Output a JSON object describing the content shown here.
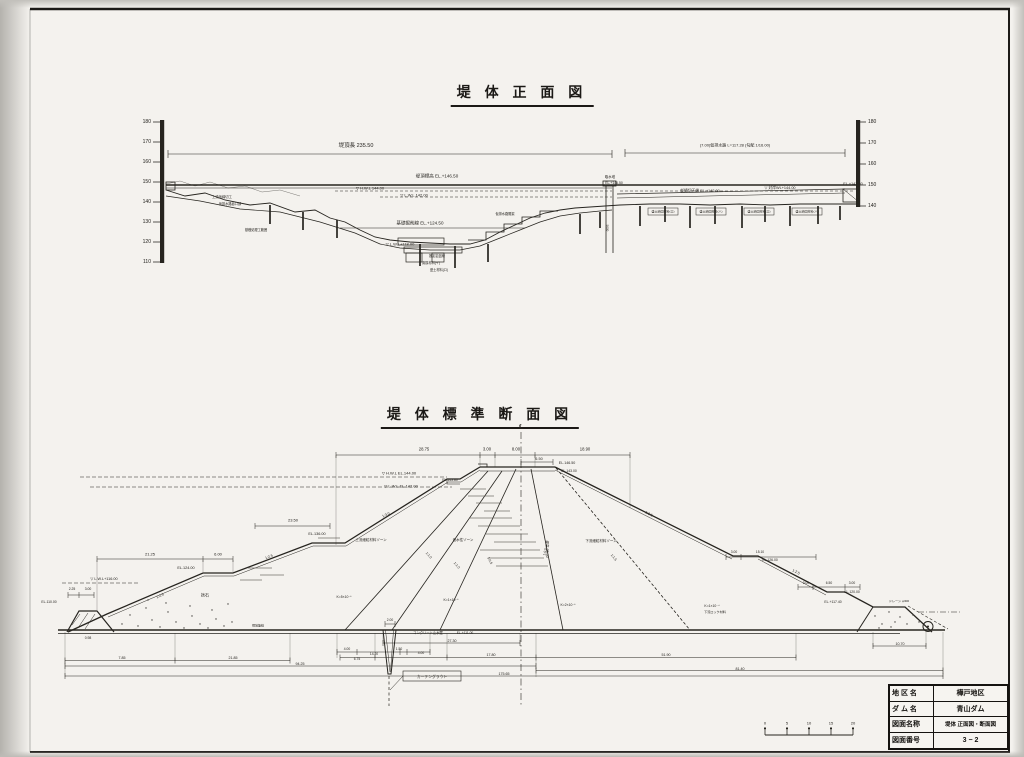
{
  "colors": {
    "paper": "#f4f2ee",
    "ink": "#26241f",
    "background": "#c9c7c2"
  },
  "front_view": {
    "title": "堤 体 正 面 図",
    "left_axis": [
      "180",
      "170",
      "160",
      "150",
      "140",
      "130",
      "120",
      "110"
    ],
    "right_axis": [
      "180",
      "170",
      "160",
      "150",
      "140"
    ],
    "labels": [
      {
        "t": "堤頂長  235.50",
        "x": 356,
        "y": 146,
        "s": 5.5
      },
      {
        "t": "(7.00)仮排水路 L=117.28 (勾配 1/16.00)",
        "x": 735,
        "y": 146,
        "s": 4
      },
      {
        "t": "堤頂標高 EL.+146.50",
        "x": 437,
        "y": 176,
        "s": 4.5
      },
      {
        "t": "▽ H.W.L 144.00",
        "x": 370,
        "y": 189,
        "s": 4
      },
      {
        "t": "▽ L.W.L 142.00",
        "x": 414,
        "y": 196,
        "s": 4
      },
      {
        "t": "基礎掘削線 EL.+124.50",
        "x": 420,
        "y": 223,
        "s": 4.5
      },
      {
        "t": "▽ L.W.L+118.00",
        "x": 400,
        "y": 245,
        "s": 4
      },
      {
        "t": "取水塔",
        "x": 610,
        "y": 178,
        "s": 3.4
      },
      {
        "t": "EL.+146.50",
        "x": 614,
        "y": 184,
        "s": 3.4
      },
      {
        "t": "仮締切天端 EL.+142.00",
        "x": 700,
        "y": 191,
        "s": 3.8
      },
      {
        "t": "▽ 対岸WL+144.00",
        "x": 780,
        "y": 188,
        "s": 3.8
      },
      {
        "t": "EL.+143.50",
        "x": 853,
        "y": 184,
        "s": 3.8
      },
      {
        "t": "上流仮締切工",
        "x": 222,
        "y": 198,
        "s": 3.3
      },
      {
        "t": "仮排水路呑口部",
        "x": 230,
        "y": 205,
        "s": 3.2
      },
      {
        "t": "基礎処理工範囲",
        "x": 256,
        "y": 231,
        "s": 3.2
      },
      {
        "t": "仮排水路開渠",
        "x": 505,
        "y": 215,
        "s": 3.2
      },
      {
        "t": "推定岩盤線",
        "x": 437,
        "y": 257,
        "s": 3.2
      },
      {
        "t": "置換材料(イ)",
        "x": 431,
        "y": 264,
        "s": 3.2
      },
      {
        "t": "盛土材料(ロ)",
        "x": 439,
        "y": 271,
        "s": 3.2
      },
      {
        "t": "盛土締固材料(ロ)",
        "x": 663,
        "y": 211.5,
        "s": 3
      },
      {
        "t": "盛土締固材料(ハ)",
        "x": 711,
        "y": 211.5,
        "s": 3
      },
      {
        "t": "盛土締固材料(ロ)",
        "x": 759,
        "y": 211.5,
        "s": 3
      },
      {
        "t": "盛土締固材料(ハ)",
        "x": 807,
        "y": 211.5,
        "s": 3
      },
      {
        "t": "5000",
        "x": 607,
        "y": 228,
        "s": 3,
        "r": 90
      }
    ]
  },
  "cross_section": {
    "title": "堤 体 標 準 断 面 図",
    "labels": [
      {
        "t": "℄",
        "x": 521,
        "y": 428,
        "s": 6
      },
      {
        "t": "28.75",
        "x": 424,
        "y": 450,
        "s": 4.2
      },
      {
        "t": "3.00",
        "x": 487,
        "y": 450,
        "s": 4.2
      },
      {
        "t": "8.00",
        "x": 516,
        "y": 450,
        "s": 4.2
      },
      {
        "t": "18.90",
        "x": 585,
        "y": 450,
        "s": 4.2
      },
      {
        "t": "6.50",
        "x": 539,
        "y": 459,
        "s": 3.8
      },
      {
        "t": "EL.146.50",
        "x": 567,
        "y": 463,
        "s": 3.6
      },
      {
        "t": "EL.143.00",
        "x": 569,
        "y": 472,
        "s": 3.4
      },
      {
        "t": "▽ H.W.L EL.144.00",
        "x": 399,
        "y": 474,
        "s": 4
      },
      {
        "t": "EL.143.80",
        "x": 450,
        "y": 481,
        "s": 3.4
      },
      {
        "t": "▽ L.W.L EL.142.00",
        "x": 401,
        "y": 487,
        "s": 4
      },
      {
        "t": "EL.136.00",
        "x": 317,
        "y": 534,
        "s": 3.8
      },
      {
        "t": "23.50",
        "x": 293,
        "y": 521,
        "s": 4
      },
      {
        "t": "21.25",
        "x": 150,
        "y": 555,
        "s": 4
      },
      {
        "t": "6.00",
        "x": 218,
        "y": 555,
        "s": 4
      },
      {
        "t": "EL.124.00",
        "x": 186,
        "y": 568,
        "s": 3.8
      },
      {
        "t": "▽ L.W.L+116.00",
        "x": 104,
        "y": 579,
        "s": 3.8
      },
      {
        "t": "2.25",
        "x": 72,
        "y": 590,
        "s": 3.4
      },
      {
        "t": "3.00",
        "x": 88,
        "y": 590,
        "s": 3.4
      },
      {
        "t": "EL.110.00",
        "x": 49,
        "y": 603,
        "s": 3.4
      },
      {
        "t": "0.98",
        "x": 88,
        "y": 639,
        "s": 3.4
      },
      {
        "t": "捨石",
        "x": 205,
        "y": 596,
        "s": 4
      },
      {
        "t": "現地盤線",
        "x": 258,
        "y": 626,
        "s": 3
      },
      {
        "t": "1:2.5",
        "x": 160,
        "y": 596,
        "s": 3.6,
        "r": -24
      },
      {
        "t": "1:2.5",
        "x": 269,
        "y": 557,
        "s": 3.6,
        "r": -21
      },
      {
        "t": "1:3.0",
        "x": 386,
        "y": 515,
        "s": 3.6,
        "r": -25
      },
      {
        "t": "上流細粒材料ゾーン",
        "x": 371,
        "y": 540,
        "s": 3.5
      },
      {
        "t": "遮水性ゾーン",
        "x": 463,
        "y": 540,
        "s": 3.5
      },
      {
        "t": "下流細粒材料ゾーン",
        "x": 601,
        "y": 541,
        "s": 3.5
      },
      {
        "t": "1:1.0",
        "x": 428,
        "y": 556,
        "s": 3.4,
        "r": 48
      },
      {
        "t": "1:1.0",
        "x": 456,
        "y": 566,
        "s": 3.4,
        "r": 49
      },
      {
        "t": "1:0.5",
        "x": 489,
        "y": 561,
        "s": 3.4,
        "r": 64
      },
      {
        "t": "1:0.5",
        "x": 546,
        "y": 552,
        "s": 3.4,
        "r": -78
      },
      {
        "t": "1:1.5",
        "x": 613,
        "y": 558,
        "s": 3.4,
        "r": 51
      },
      {
        "t": "1:2.5",
        "x": 649,
        "y": 514,
        "s": 3.6,
        "r": 27
      },
      {
        "t": "1:2.5",
        "x": 796,
        "y": 572,
        "s": 3.6,
        "r": 26
      },
      {
        "t": "堤高 35.50",
        "x": 547,
        "y": 549,
        "s": 3.6,
        "r": 90
      },
      {
        "t": "K=5×10⁻⁶",
        "x": 344,
        "y": 598,
        "s": 3.4
      },
      {
        "t": "K=1×10⁻⁶",
        "x": 451,
        "y": 601,
        "s": 3.4
      },
      {
        "t": "K=2×10⁻⁶",
        "x": 568,
        "y": 606,
        "s": 3.4
      },
      {
        "t": "K=1×10⁻⁴",
        "x": 712,
        "y": 607,
        "s": 3.4
      },
      {
        "t": "下流ロック材料",
        "x": 715,
        "y": 613,
        "s": 3.1
      },
      {
        "t": "コンクリート止水壁",
        "x": 428,
        "y": 634,
        "s": 3.3
      },
      {
        "t": "EL.+111.00",
        "x": 465,
        "y": 634,
        "s": 3.3
      },
      {
        "t": "カーテングラウト",
        "x": 432,
        "y": 676.5,
        "s": 3.8
      },
      {
        "t": "2.00",
        "x": 390,
        "y": 621,
        "s": 3.3
      },
      {
        "t": "27.30",
        "x": 452,
        "y": 640.5,
        "s": 3.6
      },
      {
        "t": "4.00",
        "x": 347,
        "y": 650,
        "s": 3.3
      },
      {
        "t": "14.20",
        "x": 374,
        "y": 655,
        "s": 3.3
      },
      {
        "t": "1.50",
        "x": 399,
        "y": 649.5,
        "s": 3.3
      },
      {
        "t": "4.00",
        "x": 421,
        "y": 654,
        "s": 3.3
      },
      {
        "t": "6.75",
        "x": 357,
        "y": 660,
        "s": 3.3
      },
      {
        "t": "17.80",
        "x": 491,
        "y": 655,
        "s": 3.6
      },
      {
        "t": "51.90",
        "x": 666,
        "y": 655,
        "s": 3.6
      },
      {
        "t": "7.85",
        "x": 122,
        "y": 658,
        "s": 3.6
      },
      {
        "t": "21.85",
        "x": 233,
        "y": 658,
        "s": 3.6
      },
      {
        "t": "94.25",
        "x": 300,
        "y": 664,
        "s": 3.6
      },
      {
        "t": "81.40",
        "x": 740,
        "y": 668.5,
        "s": 3.6
      },
      {
        "t": "175.65",
        "x": 504,
        "y": 674,
        "s": 3.6
      },
      {
        "t": "10.70",
        "x": 900,
        "y": 644,
        "s": 3.6
      },
      {
        "t": "3.00",
        "x": 734,
        "y": 553,
        "s": 3.3
      },
      {
        "t": "15.10",
        "x": 760,
        "y": 553,
        "s": 3.3
      },
      {
        "t": "EL.126.00",
        "x": 770,
        "y": 561,
        "s": 3.4
      },
      {
        "t": "3.00",
        "x": 806,
        "y": 583.5,
        "s": 3.3
      },
      {
        "t": "6.50",
        "x": 829,
        "y": 583.5,
        "s": 3.3
      },
      {
        "t": "3.00",
        "x": 852,
        "y": 583.5,
        "s": 3.3
      },
      {
        "t": "EL.120.00",
        "x": 852,
        "y": 593,
        "s": 3.4
      },
      {
        "t": "EL.+117.40",
        "x": 833,
        "y": 603,
        "s": 3.4
      },
      {
        "t": "ドレーン φ300",
        "x": 899,
        "y": 602,
        "s": 3.1
      }
    ]
  },
  "scale_bar": {
    "ticks": [
      "0",
      "5",
      "10",
      "15",
      "20"
    ]
  },
  "title_block": {
    "rows": [
      {
        "label": "地 区 名",
        "value": "樺戸地区"
      },
      {
        "label": "ダ ム 名",
        "value": "青山ダム"
      },
      {
        "label": "図面名称",
        "value": "堤体 正面図・断面図"
      },
      {
        "label": "図面番号",
        "value": "3 − 2"
      }
    ]
  }
}
